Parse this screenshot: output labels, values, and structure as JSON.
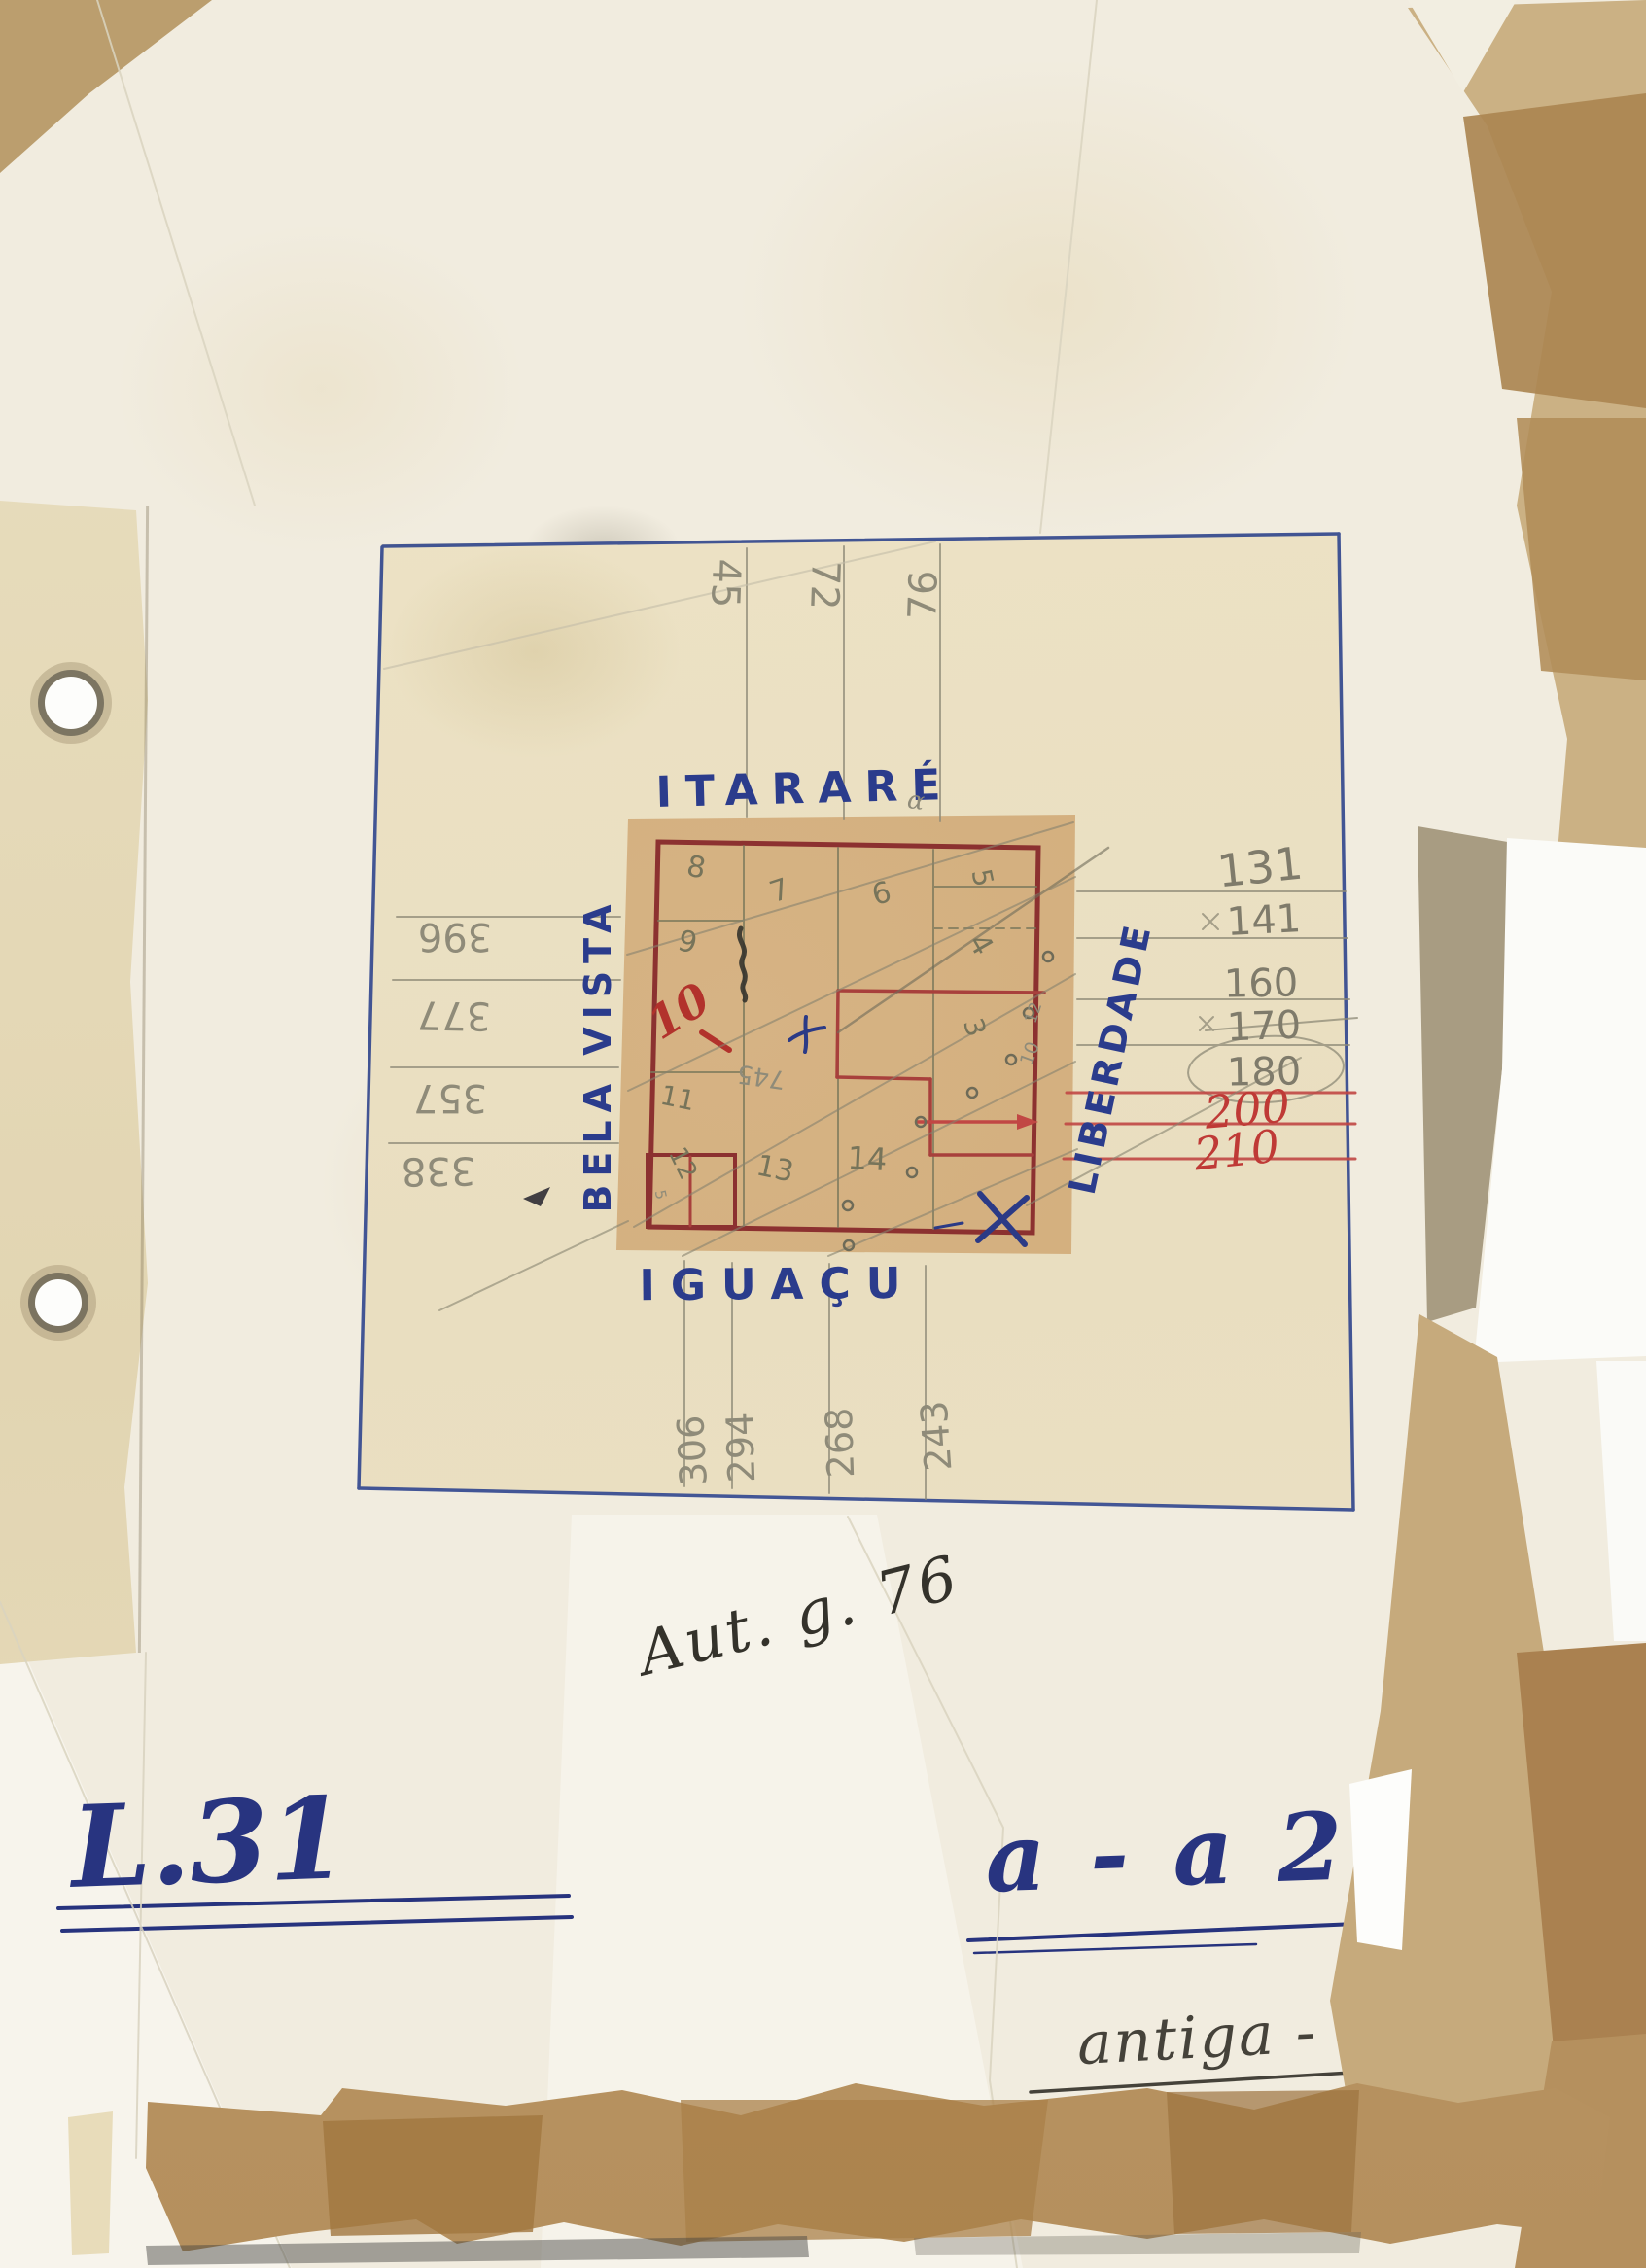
{
  "sheet": {
    "streets": {
      "top": "ITARARÉ",
      "left": "BELA VISTA",
      "right": "LIBERDADE",
      "bottom": "IGUAÇU"
    },
    "top_numbers": [
      "45",
      "72",
      "76"
    ],
    "left_numbers": [
      "396",
      "377",
      "357",
      "338"
    ],
    "right_numbers": [
      "131",
      "141",
      "160",
      "170",
      "180",
      "200",
      "210"
    ],
    "bottom_numbers": [
      "306",
      "294",
      "268",
      "243"
    ],
    "block": {
      "lot_numbers": [
        "8",
        "7",
        "6",
        "5",
        "9",
        "4",
        "3",
        "11",
        "12",
        "13",
        "14"
      ],
      "red_lot": "10",
      "depth_label": "745",
      "edge_numbers": [
        "12",
        "10"
      ],
      "corner_number": "5",
      "alpha_mark": "α"
    }
  },
  "annotations": {
    "register_note": "Aut. g. 76",
    "code_left": "L.31",
    "code_right": "a - a 2",
    "bottom_note": "antiga - 76"
  },
  "colors": {
    "blue_ink": "#2b3c8c",
    "red_ink": "#bf3a36",
    "maroon": "#8c3130",
    "pencil": "#8f8b79",
    "olive_pencil": "#77745a",
    "sheet_paper": "#ece2c4",
    "block_paper": "#d2ae7c",
    "page_paper": "#f1ecdf",
    "tape_tan": "#c9ae82",
    "tape_brown": "#a57c45"
  }
}
